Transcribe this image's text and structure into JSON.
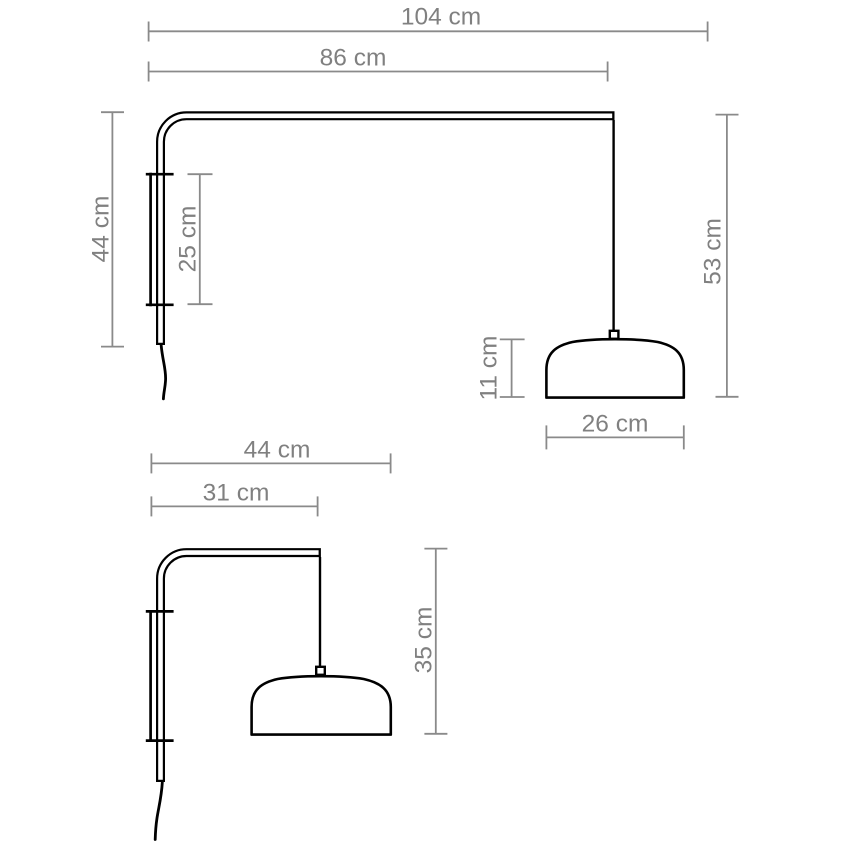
{
  "page": {
    "background": "#ffffff"
  },
  "colors": {
    "artwork": "#000000",
    "dimension_lines": "#8a8a8a",
    "dimension_text": "#808080"
  },
  "unit": "cm",
  "drawings": [
    {
      "name": "wall-lamp-large-side-view",
      "dimensions": {
        "total_width": "104 cm",
        "arm_width": "86 cm",
        "wall_height": "44 cm",
        "bracket_height": "25 cm",
        "drop_height": "53 cm",
        "shade_height": "11 cm",
        "shade_width": "26 cm"
      }
    },
    {
      "name": "wall-lamp-small-side-view",
      "dimensions": {
        "total_width": "44 cm",
        "arm_width": "31 cm",
        "drop_height": "35 cm"
      }
    }
  ]
}
